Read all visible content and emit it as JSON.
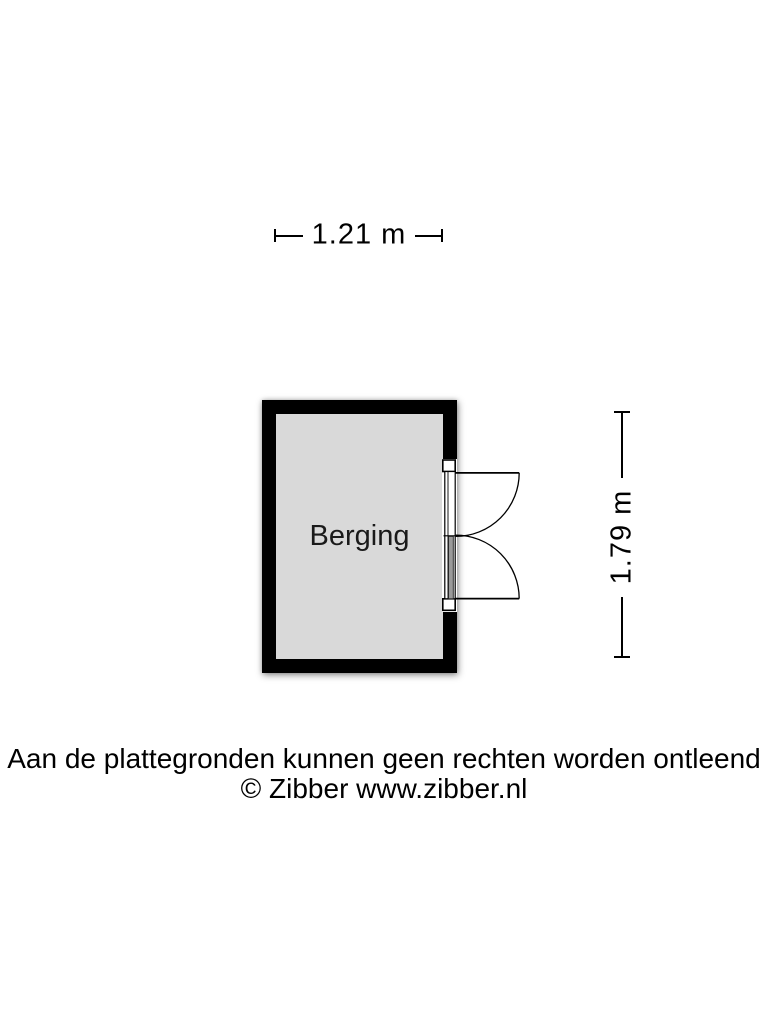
{
  "dimensions": {
    "width": {
      "label": "1.21 m"
    },
    "height": {
      "label": "1.79 m"
    }
  },
  "room": {
    "name": "Berging"
  },
  "symbols": {
    "door": "double-swing-door"
  },
  "footer": {
    "disclaimer": "Aan de plattegronden kunnen geen rechten worden ontleend",
    "copyright": "© Zibber www.zibber.nl"
  },
  "colors": {
    "bg": "#ffffff",
    "wall": "#000000",
    "floor": "#d9d9d9",
    "line": "#000000",
    "text": "#000000",
    "door-fill": "#ffffff",
    "door-leaf": "#9a9a9a"
  }
}
